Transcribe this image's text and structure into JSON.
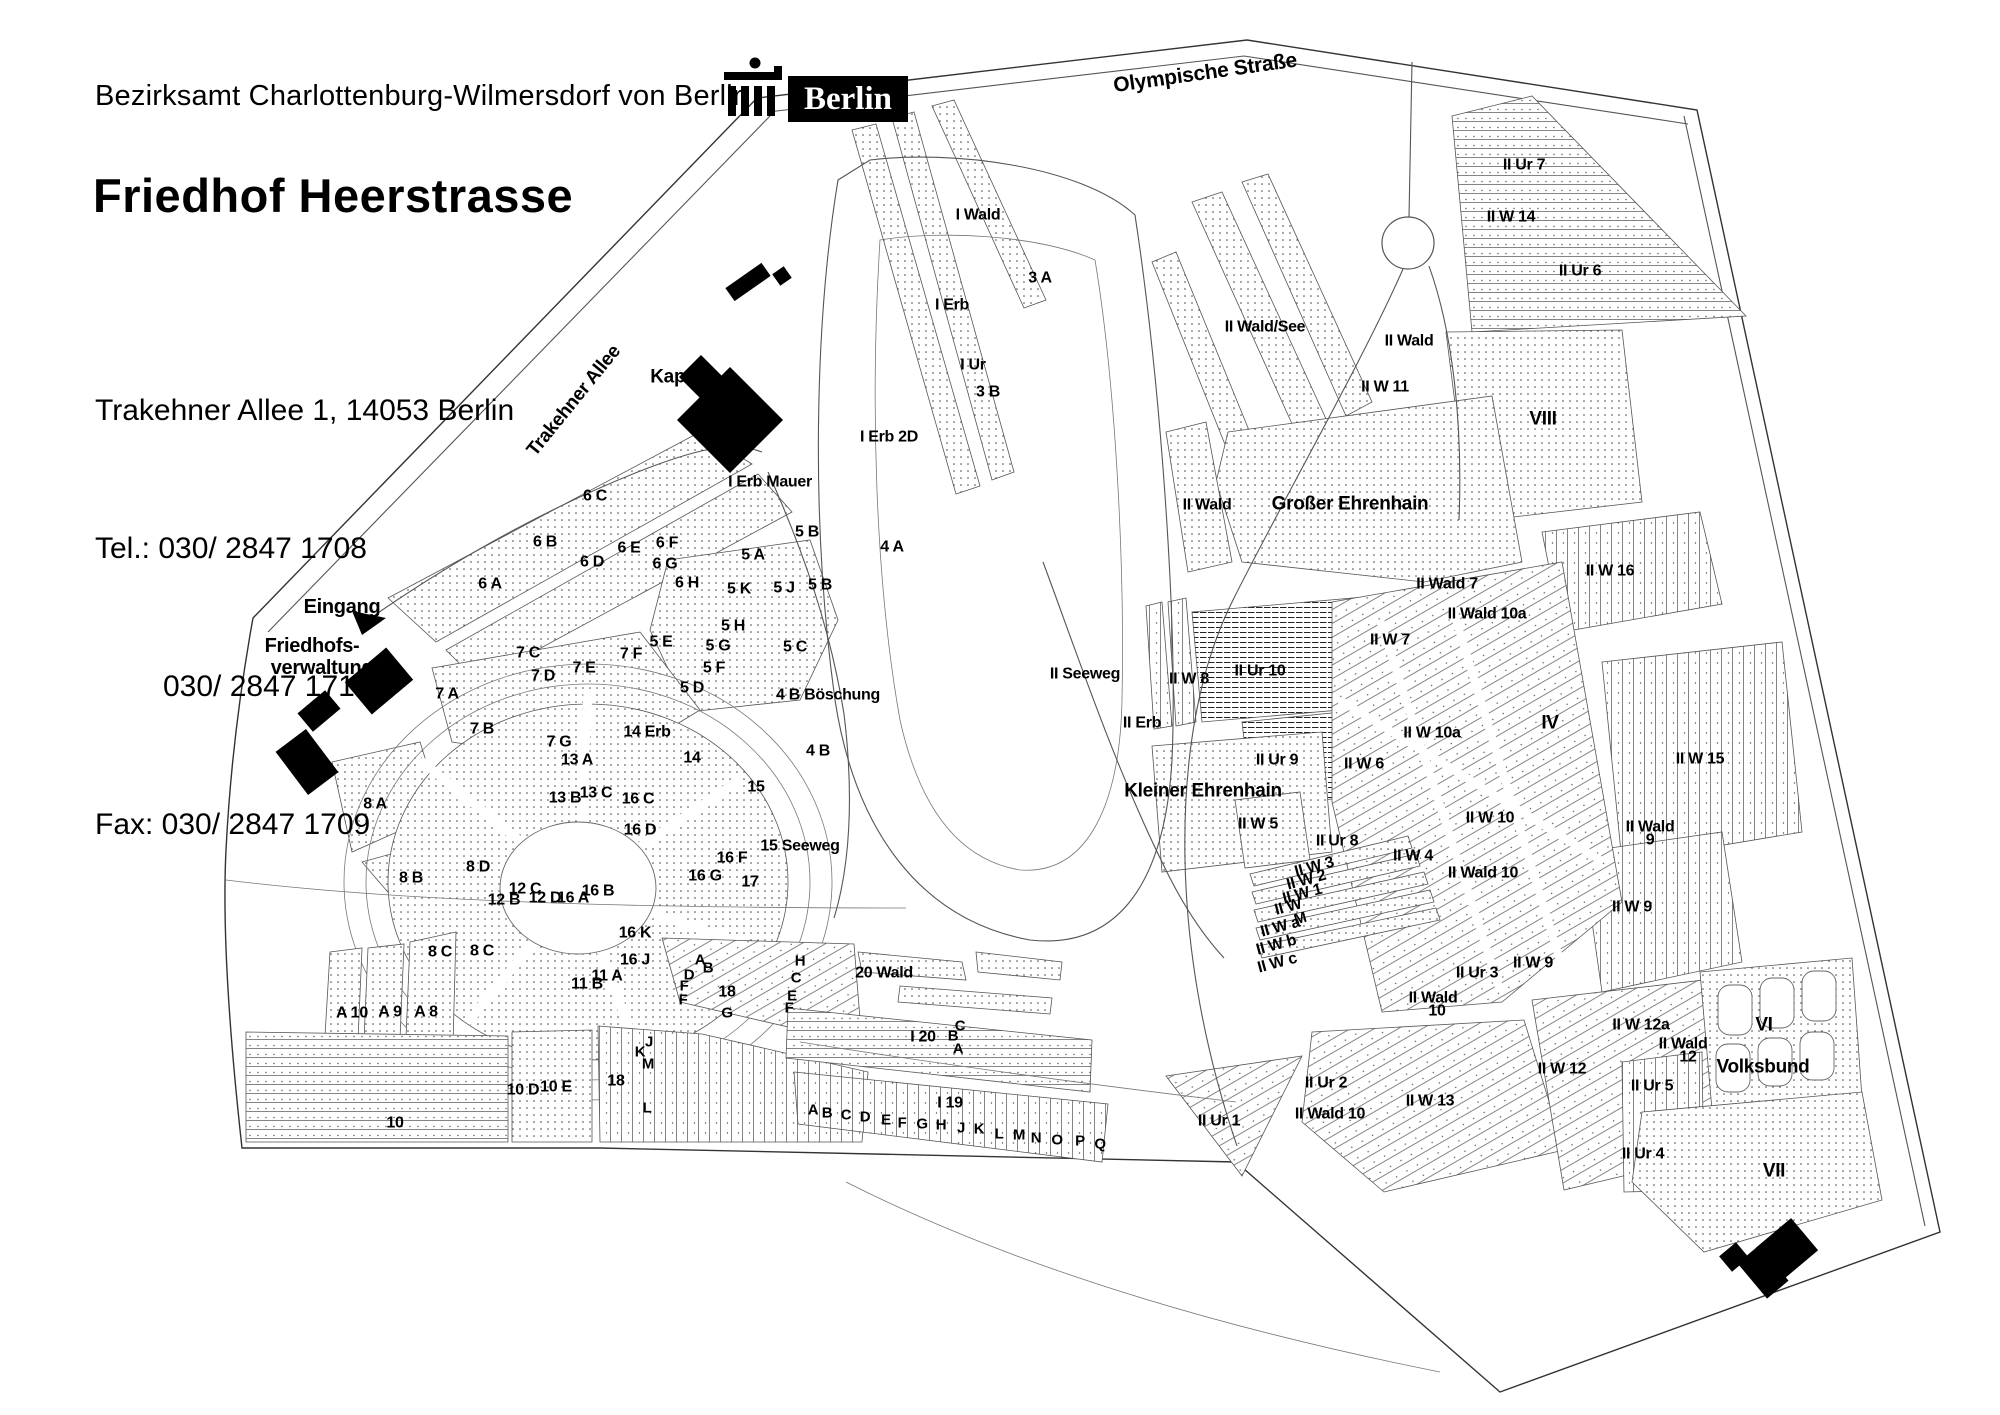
{
  "header": {
    "agency": "Bezirksamt Charlottenburg-Wilmersdorf von Berlin",
    "logo_text": "Berlin",
    "title": "Friedhof Heerstrasse",
    "address": "Trakehner Allee 1, 14053 Berlin",
    "phone1": "Tel.: 030/ 2847 1708",
    "phone2": "030/ 2847 1710",
    "fax": "Fax: 030/ 2847 1709"
  },
  "colors": {
    "ink": "#000000",
    "line": "#555555",
    "accent": "#000000"
  },
  "map": {
    "legend_note": "cemetery section plan",
    "labels": [
      [
        "Olympische Straße",
        1205,
        72,
        21,
        -8
      ],
      [
        "Trakehner Allee",
        573,
        400,
        19,
        -51
      ],
      [
        "Eingang",
        342,
        606,
        20,
        0
      ],
      [
        "Friedhofs-",
        312,
        645,
        20,
        0
      ],
      [
        "verwaltung",
        322,
        667,
        20,
        0
      ],
      [
        "Kapelle",
        683,
        376,
        19,
        0
      ],
      [
        "Großer Ehrenhain",
        1350,
        503,
        19,
        0
      ],
      [
        "Kleiner Ehrenhain",
        1203,
        790,
        19,
        0
      ],
      [
        "Volksbund",
        1763,
        1066,
        19,
        0
      ],
      [
        "I Wald",
        978,
        214,
        0,
        0
      ],
      [
        "3 A",
        1040,
        277,
        0,
        0
      ],
      [
        "I Erb",
        952,
        304,
        0,
        0
      ],
      [
        "I Ur",
        973,
        364,
        0,
        0
      ],
      [
        "3 B",
        988,
        391,
        0,
        0
      ],
      [
        "I Erb 2D",
        889,
        436,
        0,
        0
      ],
      [
        "I Erb Mauer",
        770,
        481,
        0,
        0
      ],
      [
        "4 A",
        892,
        546,
        0,
        0
      ],
      [
        "6 C",
        595,
        495,
        0,
        0
      ],
      [
        "6 B",
        545,
        541,
        0,
        0
      ],
      [
        "6 E",
        629,
        547,
        0,
        0
      ],
      [
        "6 F",
        667,
        542,
        0,
        0
      ],
      [
        "6 D",
        592,
        561,
        0,
        0
      ],
      [
        "6 G",
        665,
        563,
        0,
        0
      ],
      [
        "6 A",
        490,
        583,
        0,
        0
      ],
      [
        "6 H",
        687,
        582,
        0,
        0
      ],
      [
        "5 A",
        753,
        554,
        0,
        0
      ],
      [
        "5 B",
        807,
        531,
        0,
        0
      ],
      [
        "5 B",
        820,
        584,
        0,
        0
      ],
      [
        "5 K",
        739,
        588,
        0,
        0
      ],
      [
        "5 J",
        784,
        587,
        0,
        0
      ],
      [
        "5 H",
        733,
        625,
        0,
        0
      ],
      [
        "5 E",
        661,
        641,
        0,
        0
      ],
      [
        "5 G",
        718,
        645,
        0,
        0
      ],
      [
        "5 F",
        714,
        667,
        0,
        0
      ],
      [
        "5 C",
        795,
        646,
        0,
        0
      ],
      [
        "5 D",
        692,
        687,
        0,
        0
      ],
      [
        "7 C",
        528,
        652,
        0,
        0
      ],
      [
        "7 F",
        631,
        653,
        0,
        0
      ],
      [
        "7 E",
        584,
        667,
        0,
        0
      ],
      [
        "7 D",
        543,
        675,
        0,
        0
      ],
      [
        "7 A",
        447,
        693,
        0,
        0
      ],
      [
        "7 B",
        482,
        728,
        0,
        0
      ],
      [
        "7 G",
        559,
        741,
        0,
        0
      ],
      [
        "4 B Böschung",
        828,
        694,
        0,
        0
      ],
      [
        "4 B",
        818,
        750,
        0,
        0
      ],
      [
        "14 Erb",
        647,
        731,
        0,
        0
      ],
      [
        "14",
        692,
        757,
        0,
        0
      ],
      [
        "13 A",
        577,
        759,
        0,
        0
      ],
      [
        "13 C",
        596,
        792,
        0,
        0
      ],
      [
        "13 B",
        565,
        797,
        0,
        0
      ],
      [
        "15",
        756,
        786,
        0,
        0
      ],
      [
        "15 Seeweg",
        800,
        845,
        0,
        0
      ],
      [
        "16 C",
        638,
        798,
        0,
        0
      ],
      [
        "16 D",
        640,
        829,
        0,
        0
      ],
      [
        "16 F",
        732,
        857,
        0,
        0
      ],
      [
        "16 G",
        705,
        875,
        0,
        0
      ],
      [
        "16 B",
        598,
        890,
        0,
        0
      ],
      [
        "16 A",
        573,
        897,
        0,
        0
      ],
      [
        "16 K",
        635,
        932,
        0,
        0
      ],
      [
        "16 J",
        635,
        959,
        0,
        0
      ],
      [
        "17",
        750,
        881,
        0,
        0
      ],
      [
        "8 A",
        375,
        803,
        0,
        0
      ],
      [
        "8 B",
        411,
        877,
        0,
        0
      ],
      [
        "8 D",
        478,
        866,
        0,
        0
      ],
      [
        "8 C",
        440,
        951,
        0,
        0
      ],
      [
        "8 C",
        482,
        950,
        0,
        0
      ],
      [
        "12 C",
        525,
        888,
        0,
        0
      ],
      [
        "12 B",
        504,
        899,
        0,
        0
      ],
      [
        "12 D",
        545,
        897,
        0,
        0
      ],
      [
        "11 A",
        607,
        975,
        0,
        0
      ],
      [
        "11 B",
        587,
        983,
        0,
        0
      ],
      [
        "A 10",
        352,
        1012,
        0,
        0
      ],
      [
        "A 9",
        390,
        1011,
        0,
        0
      ],
      [
        "A 8",
        426,
        1011,
        0,
        0
      ],
      [
        "10",
        395,
        1122,
        0,
        0
      ],
      [
        "10 D",
        523,
        1089,
        0,
        0
      ],
      [
        "10 E",
        556,
        1086,
        0,
        0
      ],
      [
        "18",
        616,
        1080,
        0,
        0
      ],
      [
        "L",
        647,
        1107,
        15,
        0
      ],
      [
        "J",
        649,
        1041,
        15,
        0
      ],
      [
        "K",
        640,
        1051,
        15,
        0
      ],
      [
        "M",
        648,
        1063,
        15,
        0
      ],
      [
        "A",
        700,
        959,
        15,
        0
      ],
      [
        "B",
        708,
        967,
        15,
        0
      ],
      [
        "D",
        689,
        974,
        15,
        0
      ],
      [
        "F",
        684,
        985,
        15,
        0
      ],
      [
        "F",
        683,
        999,
        15,
        0
      ],
      [
        "18",
        727,
        991,
        0,
        0
      ],
      [
        "G",
        727,
        1012,
        15,
        0
      ],
      [
        "H",
        800,
        960,
        15,
        0
      ],
      [
        "C",
        796,
        977,
        15,
        0
      ],
      [
        "E",
        792,
        995,
        15,
        0
      ],
      [
        "F",
        789,
        1007,
        15,
        0
      ],
      [
        "20 Wald",
        884,
        972,
        0,
        0
      ],
      [
        "I 20",
        923,
        1036,
        0,
        0
      ],
      [
        "C",
        960,
        1025,
        15,
        0
      ],
      [
        "B",
        953,
        1035,
        15,
        0
      ],
      [
        "A",
        958,
        1048,
        15,
        0
      ],
      [
        "I 19",
        950,
        1102,
        0,
        0
      ],
      [
        "A",
        813,
        1109,
        15,
        0
      ],
      [
        "B",
        827,
        1112,
        15,
        0
      ],
      [
        "C",
        846,
        1114,
        15,
        0
      ],
      [
        "D",
        865,
        1116,
        15,
        0
      ],
      [
        "E",
        886,
        1119,
        15,
        0
      ],
      [
        "F",
        902,
        1122,
        15,
        0
      ],
      [
        "G",
        922,
        1123,
        15,
        0
      ],
      [
        "H",
        941,
        1124,
        15,
        0
      ],
      [
        "J",
        961,
        1127,
        15,
        0
      ],
      [
        "K",
        979,
        1128,
        15,
        0
      ],
      [
        "L",
        999,
        1133,
        15,
        0
      ],
      [
        "M",
        1019,
        1134,
        15,
        0
      ],
      [
        "N",
        1036,
        1137,
        15,
        0
      ],
      [
        "O",
        1057,
        1139,
        15,
        0
      ],
      [
        "P",
        1080,
        1140,
        15,
        0
      ],
      [
        "Q",
        1100,
        1143,
        15,
        0
      ],
      [
        "II Ur 1",
        1219,
        1120,
        0,
        0
      ],
      [
        "II Wald 10",
        1330,
        1113,
        0,
        0
      ],
      [
        "II W 13",
        1430,
        1100,
        0,
        0
      ],
      [
        "II Ur 2",
        1326,
        1082,
        0,
        0
      ],
      [
        "II W 12",
        1562,
        1068,
        0,
        0
      ],
      [
        "II Seeweg",
        1085,
        673,
        0,
        0
      ],
      [
        "II Erb",
        1142,
        722,
        0,
        0
      ],
      [
        "II W 8",
        1189,
        678,
        0,
        0
      ],
      [
        "II Ur 10",
        1260,
        670,
        0,
        0
      ],
      [
        "II W 7",
        1390,
        639,
        0,
        0
      ],
      [
        "II Wald 7",
        1447,
        583,
        0,
        0
      ],
      [
        "II Wald 10a",
        1487,
        613,
        0,
        0
      ],
      [
        "II W 16",
        1610,
        570,
        0,
        0
      ],
      [
        "IV",
        1550,
        722,
        19,
        0
      ],
      [
        "II W 10a",
        1432,
        732,
        0,
        0
      ],
      [
        "II Ur 9",
        1277,
        759,
        0,
        0
      ],
      [
        "II W 6",
        1364,
        763,
        0,
        0
      ],
      [
        "II W 15",
        1700,
        758,
        0,
        0
      ],
      [
        "II W 5",
        1258,
        823,
        0,
        0
      ],
      [
        "II Ur 8",
        1337,
        840,
        0,
        0
      ],
      [
        "II W 10",
        1490,
        817,
        0,
        0
      ],
      [
        "II Wald",
        1650,
        826,
        0,
        0
      ],
      [
        "9",
        1650,
        839,
        0,
        0
      ],
      [
        "II W 9",
        1632,
        906,
        0,
        0
      ],
      [
        "II W 3",
        1314,
        866,
        0,
        -15
      ],
      [
        "II W 2",
        1306,
        879,
        0,
        -15
      ],
      [
        "II W 1",
        1302,
        893,
        0,
        -15
      ],
      [
        "II W",
        1288,
        906,
        0,
        -15
      ],
      [
        "M",
        1300,
        918,
        15,
        -15
      ],
      [
        "II W a",
        1280,
        926,
        0,
        -15
      ],
      [
        "II W b",
        1276,
        944,
        0,
        -15
      ],
      [
        "II W c",
        1277,
        962,
        0,
        -15
      ],
      [
        "II W 4",
        1413,
        855,
        0,
        0
      ],
      [
        "II Wald 10",
        1483,
        872,
        0,
        0
      ],
      [
        "II Ur 3",
        1477,
        972,
        0,
        0
      ],
      [
        "II W 9",
        1533,
        962,
        0,
        0
      ],
      [
        "II Wald",
        1433,
        997,
        0,
        0
      ],
      [
        "10",
        1437,
        1010,
        0,
        0
      ],
      [
        "II W 12a",
        1641,
        1024,
        0,
        0
      ],
      [
        "II Wald",
        1683,
        1043,
        0,
        0
      ],
      [
        "12",
        1688,
        1056,
        0,
        0
      ],
      [
        "II Ur 5",
        1652,
        1085,
        0,
        0
      ],
      [
        "II Ur 4",
        1643,
        1153,
        0,
        0
      ],
      [
        "VI",
        1764,
        1024,
        19,
        0
      ],
      [
        "VII",
        1774,
        1170,
        19,
        0
      ],
      [
        "II Ur 7",
        1524,
        164,
        0,
        0
      ],
      [
        "II W 14",
        1511,
        216,
        0,
        0
      ],
      [
        "II Ur 6",
        1580,
        270,
        0,
        0
      ],
      [
        "II Wald/See",
        1265,
        326,
        0,
        0
      ],
      [
        "II Wald",
        1409,
        340,
        0,
        0
      ],
      [
        "II W 11",
        1385,
        386,
        0,
        0
      ],
      [
        "VIII",
        1543,
        418,
        19,
        0
      ],
      [
        "II Wald",
        1207,
        504,
        0,
        0
      ]
    ]
  }
}
